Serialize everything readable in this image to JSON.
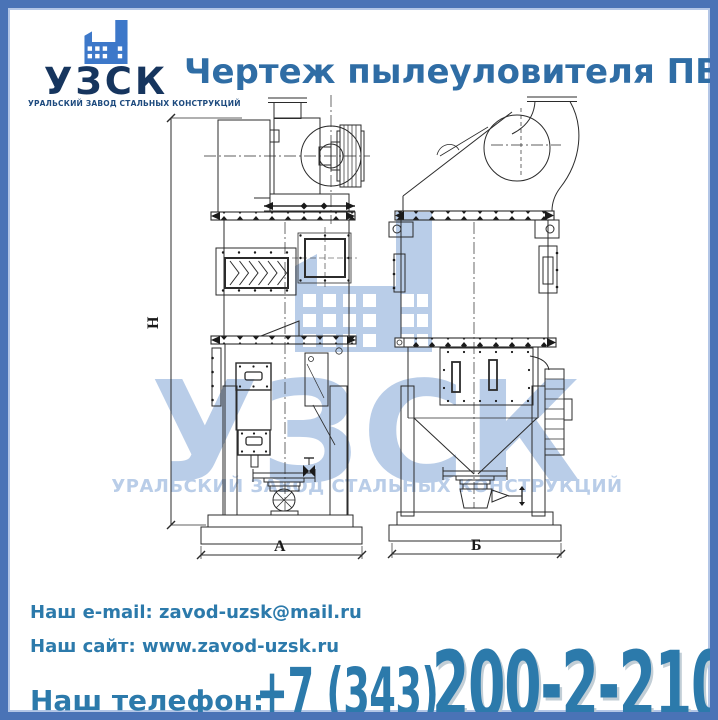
{
  "page": {
    "border_color": "#4a73b6",
    "background": "#ffffff"
  },
  "logo": {
    "icon": "factory-icon",
    "icon_color": "#3d78c9",
    "name": "УЗСК",
    "name_color": "#16355e",
    "tagline": "УРАЛЬСКИЙ ЗАВОД СТАЛЬНЫХ КОНСТРУКЦИЙ"
  },
  "title": {
    "text": "Чертеж пылеуловителя ПВМ",
    "color": "#2f6da5"
  },
  "drawing": {
    "dimensions": {
      "height_label": "Н",
      "front_width_label": "А",
      "side_width_label": "Б"
    },
    "watermark": {
      "icon": "factory-icon",
      "name": "УЗСК",
      "tagline": "УРАЛЬСКИЙ ЗАВОД СТАЛЬНЫХ КОНСТРУКЦИЙ",
      "color": "#b9cde8"
    }
  },
  "footer": {
    "email_label": "Наш e-mail:",
    "email_value": "zavod-uzsk@mail.ru",
    "site_label": "Наш сайт:",
    "site_value": "www.zavod-uzsk.ru",
    "phone_label": "Наш телефон:",
    "phone_prefix": "+7 (343)",
    "phone_number": "200-2-210",
    "text_color": "#2c7aab"
  }
}
